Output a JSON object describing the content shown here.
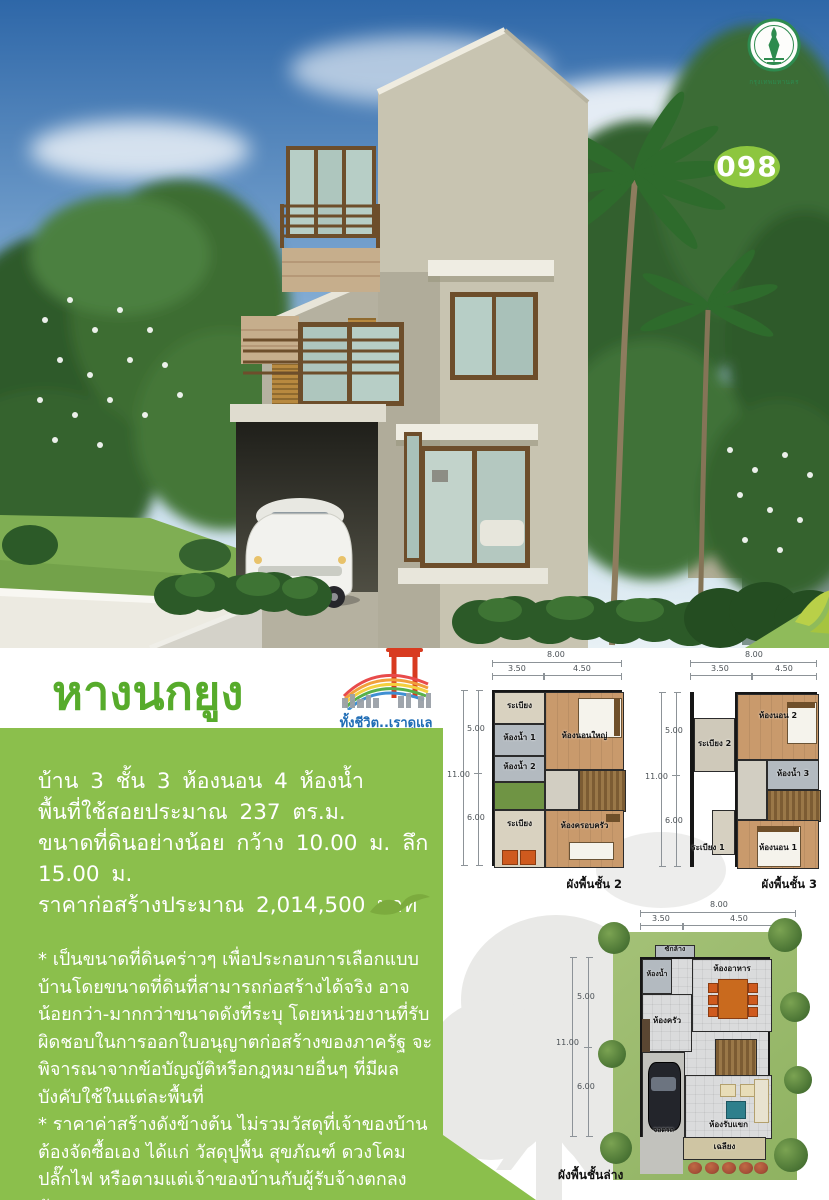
{
  "badge": {
    "number": "098"
  },
  "seal": {
    "caption": "กรุงเทพมหานคร"
  },
  "header": {
    "title": "หางนกยูง",
    "logo_tagline": "ทั้งชีวิต..เราดูแล"
  },
  "specs": {
    "line1": "บ้าน 3 ชั้น 3 ห้องนอน 4 ห้องน้ำ",
    "line2": "พื้นที่ใช้สอยประมาณ 237 ตร.ม.",
    "line3": "ขนาดที่ดินอย่างน้อย กว้าง 10.00 ม. ลึก 15.00 ม.",
    "line4": "ราคาก่อสร้างประมาณ 2,014,500 บาท"
  },
  "notes": {
    "para1": "* เป็นขนาดที่ดินคร่าวๆ เพื่อประกอบการเลือกแบบบ้านโดยขนาดที่ดินที่สามารถก่อสร้างได้จริง อาจน้อยกว่า-มากกว่าขนาดดังที่ระบุ โดยหน่วยงานที่รับผิดชอบในการออกใบอนุญาตก่อสร้างของภาครัฐ จะพิจารณาจากข้อบัญญัติหรือกฎหมายอื่นๆ ที่มีผลบังคับใช้ในแต่ละพื้นที่",
    "para2": "* ราคาค่าสร้างดังข้างต้น ไม่รวมวัสดุที่เจ้าของบ้านต้องจัดซื้อเอง ได้แก่ วัสดุปูพื้น สุขภัณฑ์ ดวงโคม ปลั๊กไฟ หรือตามแต่เจ้าของบ้านกับผู้รับจ้างตกลงกันเอง"
  },
  "plans": {
    "dims": {
      "w_total": "8.00",
      "w_left": "3.50",
      "w_right": "4.50",
      "h_total": "11.00",
      "h_top": "5.00",
      "h_bottom": "6.00"
    },
    "floor2": {
      "caption": "ผังพื้นชั้น 2",
      "rooms": {
        "balcony_top": "ระเบียง",
        "bath1": "ห้องน้ำ 1",
        "bath2": "ห้องน้ำ 2",
        "master_bedroom": "ห้องนอนใหญ่",
        "balcony_bottom": "ระเบียง",
        "family": "ห้องครอบครัว"
      }
    },
    "floor3": {
      "caption": "ผังพื้นชั้น 3",
      "rooms": {
        "bedroom2": "ห้องนอน 2",
        "balcony2": "ระเบียง 2",
        "bath3": "ห้องน้ำ 3",
        "balcony1": "ระเบียง 1",
        "bedroom1": "ห้องนอน 1"
      }
    },
    "ground": {
      "caption": "ผังพื้นชั้นล่าง",
      "rooms": {
        "laundry": "ซักล้าง",
        "bath": "ห้องน้ำ",
        "dining": "ห้องอาหาร",
        "kitchen": "ห้องครัว",
        "carport": "จอดรถ",
        "living": "ห้องรับแขก",
        "porch": "เฉลียง"
      }
    }
  },
  "colors": {
    "panel_green": "#8bbf4c",
    "title_green": "#57ab2b",
    "badge_green": "#8dc63f",
    "seal_green": "#2e8b4f"
  }
}
